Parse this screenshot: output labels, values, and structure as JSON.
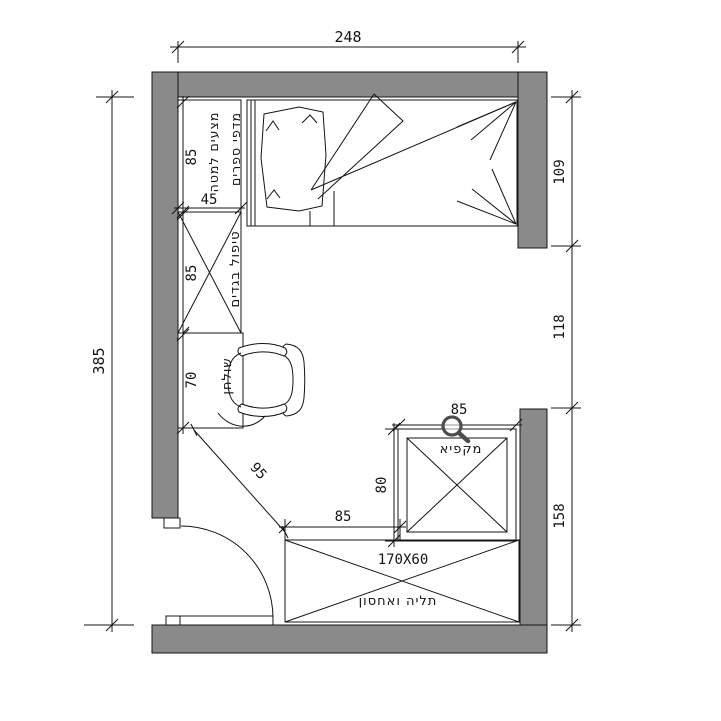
{
  "plan_name": "bedroom-floor-plan",
  "colors": {
    "wall": "#8a8a8a",
    "line": "#141414",
    "background": "#ffffff",
    "cursor": "#4d4d4d"
  },
  "dims": {
    "width_top": "248",
    "height_left": "385",
    "right_upper": "109",
    "right_middle": "118",
    "right_lower": "158",
    "shelf_len": "85",
    "shelf_depth": "45",
    "closet_len": "85",
    "desk_len": "70",
    "clearance": "95",
    "cab_width": "85",
    "cab_depth": "80",
    "wardrobe_offset": "85",
    "wardrobe_size": "170X60"
  },
  "labels": {
    "linens": "מצעים למטה",
    "bookshelves": "מדפי ספרים",
    "closet": "טיפול בגדים",
    "desk": "שולחן",
    "freezer": "מקפיא",
    "storage": "תליה ואחסון"
  },
  "cursor": {
    "type": "zoom-magnifier"
  }
}
